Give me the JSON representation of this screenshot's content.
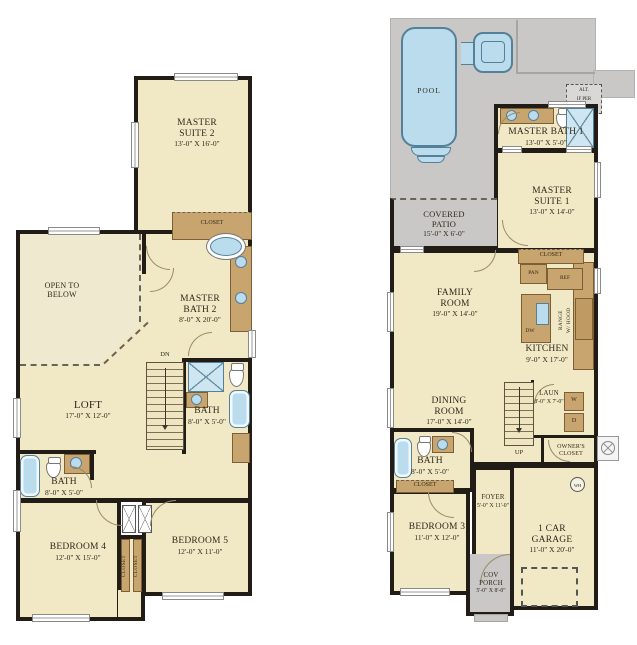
{
  "colors": {
    "floor": "#f1e8c6",
    "openfloor": "#efe9cf",
    "wall": "#211c15",
    "cab": "#c8a46e",
    "cabline": "#7c5f35",
    "deck": "#c9c8c6",
    "water": "#badcec",
    "waterline": "#55809a",
    "ink": "#30291a"
  },
  "floor2": {
    "master_suite_2": {
      "name": "MASTER SUITE 2",
      "dims": "13'-0\" X 16'-0\""
    },
    "ms2_closet": "CLOSET",
    "master_bath_2": {
      "name": "MASTER BATH 2",
      "dims": "8'-0\" X 20'-0\""
    },
    "open_to_below": "OPEN TO BELOW",
    "stairs_down": "DN",
    "hall_bath": {
      "name": "BATH",
      "dims": "8'-0\" X 5'-0\""
    },
    "loft": {
      "name": "LOFT",
      "dims": "17'-0\" X 12'-0\""
    },
    "left_bath": {
      "name": "BATH",
      "dims": "8'-0\" X 5'-0\""
    },
    "bedroom_4": {
      "name": "BEDROOM 4",
      "dims": "12'-0\" X 15'-0\""
    },
    "bedroom_5": {
      "name": "BEDROOM 5",
      "dims": "12'-0\" X 11'-0\""
    },
    "closet_a": "CLOSET",
    "closet_b": "CLOSET"
  },
  "floor1": {
    "pool": "POOL",
    "alt_note": {
      "l1": "ALT.",
      "l2": "IF PER",
      "l3": "MUNIC."
    },
    "master_bath_1": {
      "name": "MASTER BATH 1",
      "dims": "13'-0\" X 5'-0\""
    },
    "master_suite_1": {
      "name": "MASTER SUITE 1",
      "dims": "13'-0\" X 14'-0\""
    },
    "covered_patio": {
      "name": "COVERED PATIO",
      "dims": "15'-0\" X 6'-0\""
    },
    "kitchen_closet": "CLOSET",
    "pantry": "PAN",
    "fridge": "REF",
    "family_room": {
      "name": "FAMILY ROOM",
      "dims": "19'-0\" X 14'-0\""
    },
    "kitchen": {
      "name": "KITCHEN",
      "dims": "9'-0\" X 17'-0\""
    },
    "dishwasher": "DW",
    "range_line1": "RANGE",
    "range_line2": "W/ HOOD",
    "dining_room": {
      "name": "DINING ROOM",
      "dims": "17'-0\" X 14'-0\""
    },
    "laundry": {
      "name": "LAUN",
      "dims": "8'-0\" X 7'-0\""
    },
    "washer": "W",
    "dryer": "D",
    "stairs_up": "UP",
    "owners_closet": {
      "name": "OWNER'S CLOSET"
    },
    "water_heater": "WH",
    "bath": {
      "name": "BATH",
      "dims": "8'-0\" X 5'-0\""
    },
    "bath_closet": "CLOSET",
    "bedroom_3": {
      "name": "BEDROOM 3",
      "dims": "11'-0\" X 12'-0\""
    },
    "foyer": {
      "name": "FOYER",
      "dims": "5'-0\" X 11'-0\""
    },
    "garage": {
      "name": "1 CAR GARAGE",
      "dims": "11'-0\" X 20'-0\""
    },
    "cov_porch": {
      "name": "COV PORCH",
      "dims": "5'-0\" X 8'-0\""
    }
  }
}
